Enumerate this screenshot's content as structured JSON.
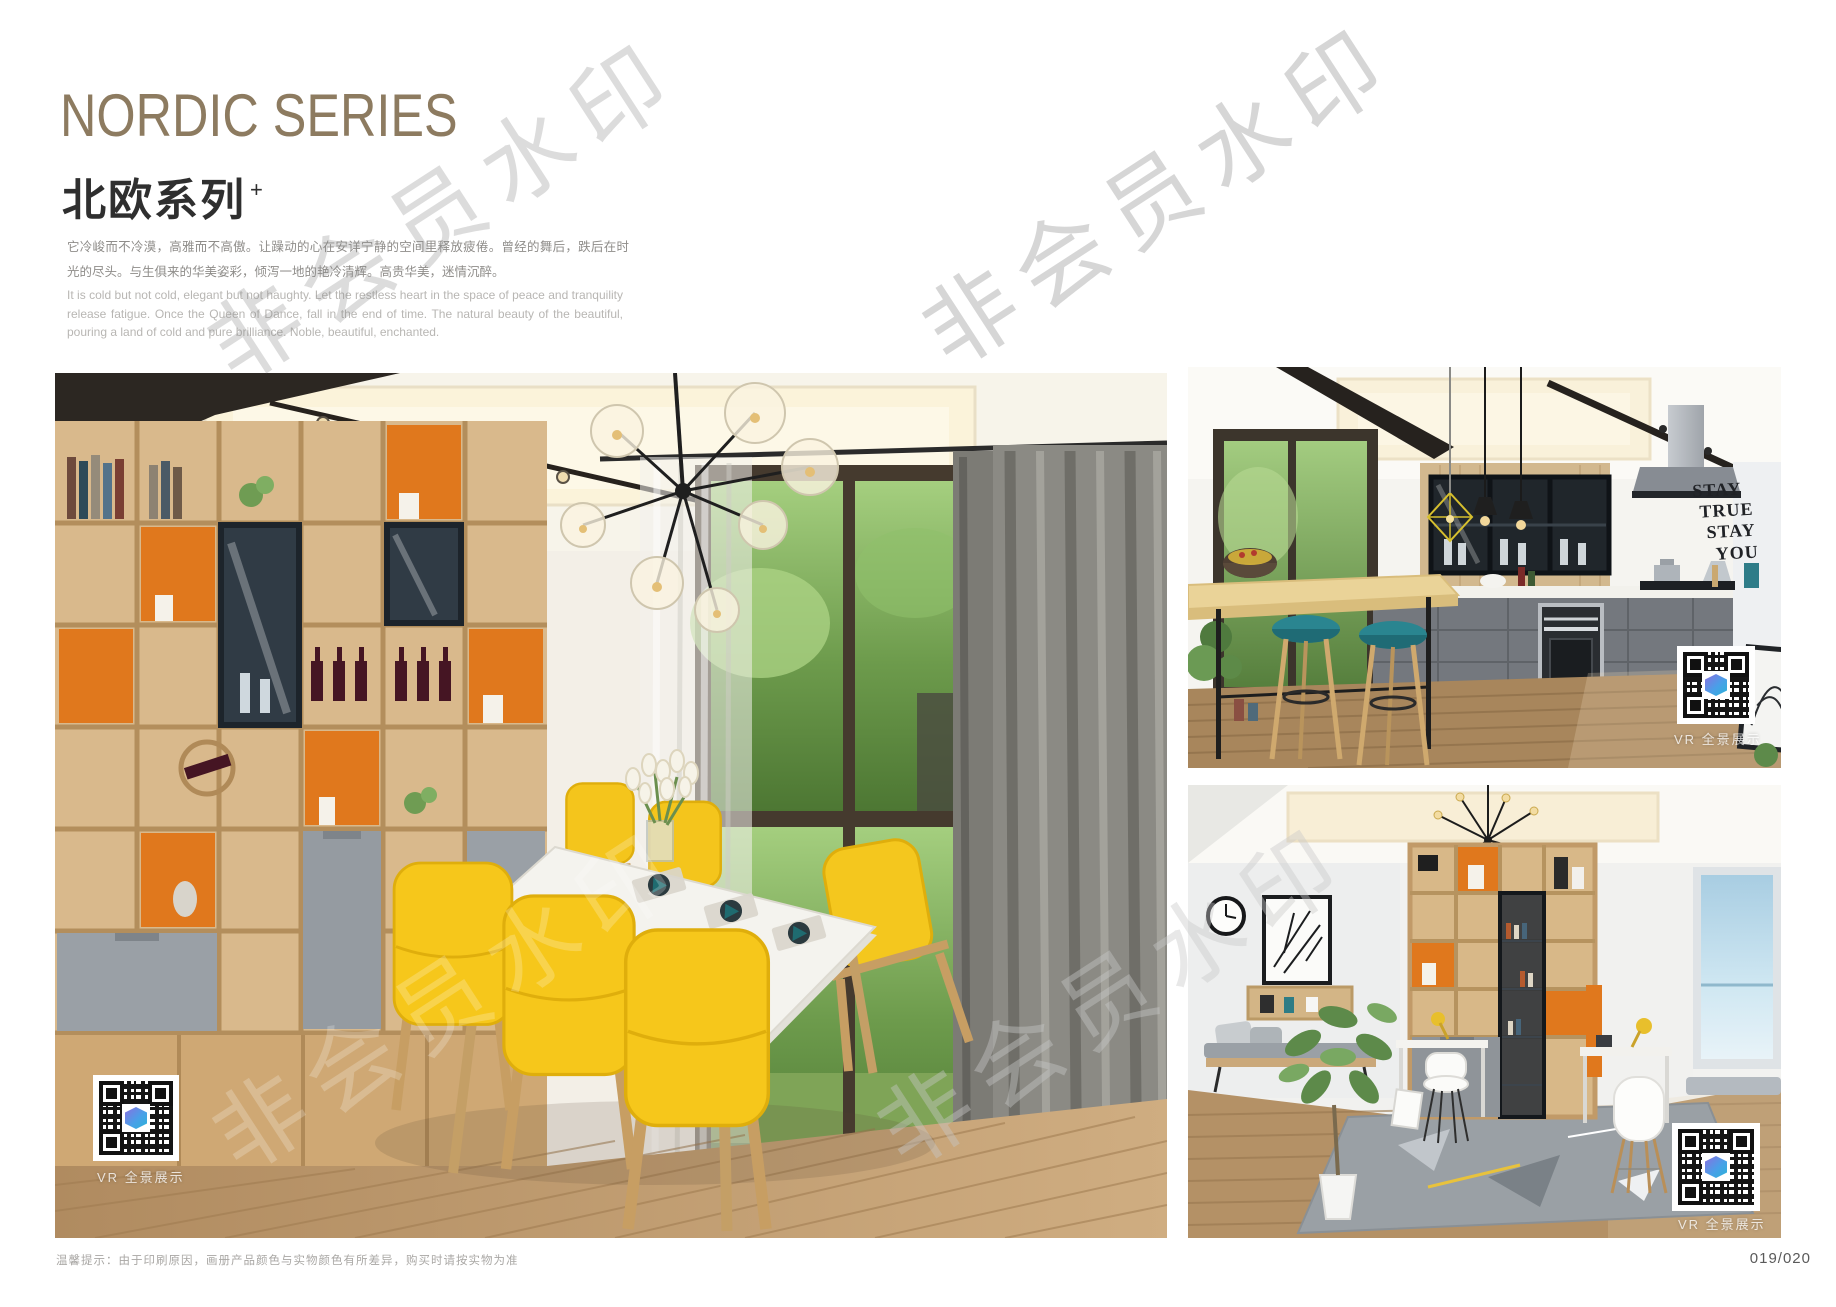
{
  "header": {
    "title_en": "NORDIC SERIES",
    "title_cn": "北欧系列",
    "title_superscript": "+",
    "paragraph_cn": "它冷峻而不冷漠，高雅而不高傲。让躁动的心在安详宁静的空间里释放疲倦。曾经的舞后，跌后在时光的尽头。与生俱来的华美姿彩，倾泻一地的艳冷清辉。高贵华美，迷情沉醉。",
    "paragraph_en": "It is cold but not cold, elegant but not haughty. Let the restless heart in the space of peace and tranquility release fatigue. Once the Queen of Dance, fall in the end of time. The natural beauty of the beautiful, pouring a land of cold and pure brilliance. Noble, beautiful, enchanted."
  },
  "watermark": {
    "text": "非会员水印"
  },
  "photos": {
    "dining": {
      "vr_label": "VR 全景展示"
    },
    "kitchen": {
      "vr_label": "VR 全景展示",
      "wall_art_lines": [
        "STAY",
        "TRUE",
        "STAY",
        "YOU"
      ]
    },
    "study": {
      "vr_label": "VR 全景展示"
    }
  },
  "footer": {
    "note": "温馨提示：由于印刷原因，画册产品颜色与实物颜色有所差异，购买时请按实物为准",
    "page_number": "019/020"
  },
  "colors": {
    "title_accent": "#8d7b60",
    "orange_accent": "#e0781d",
    "chair_yellow": "#f6c71b",
    "stool_teal": "#2a8590",
    "qr_logo_blue": "#4a9fe8",
    "watermark_gray": "#8c8c8c"
  }
}
